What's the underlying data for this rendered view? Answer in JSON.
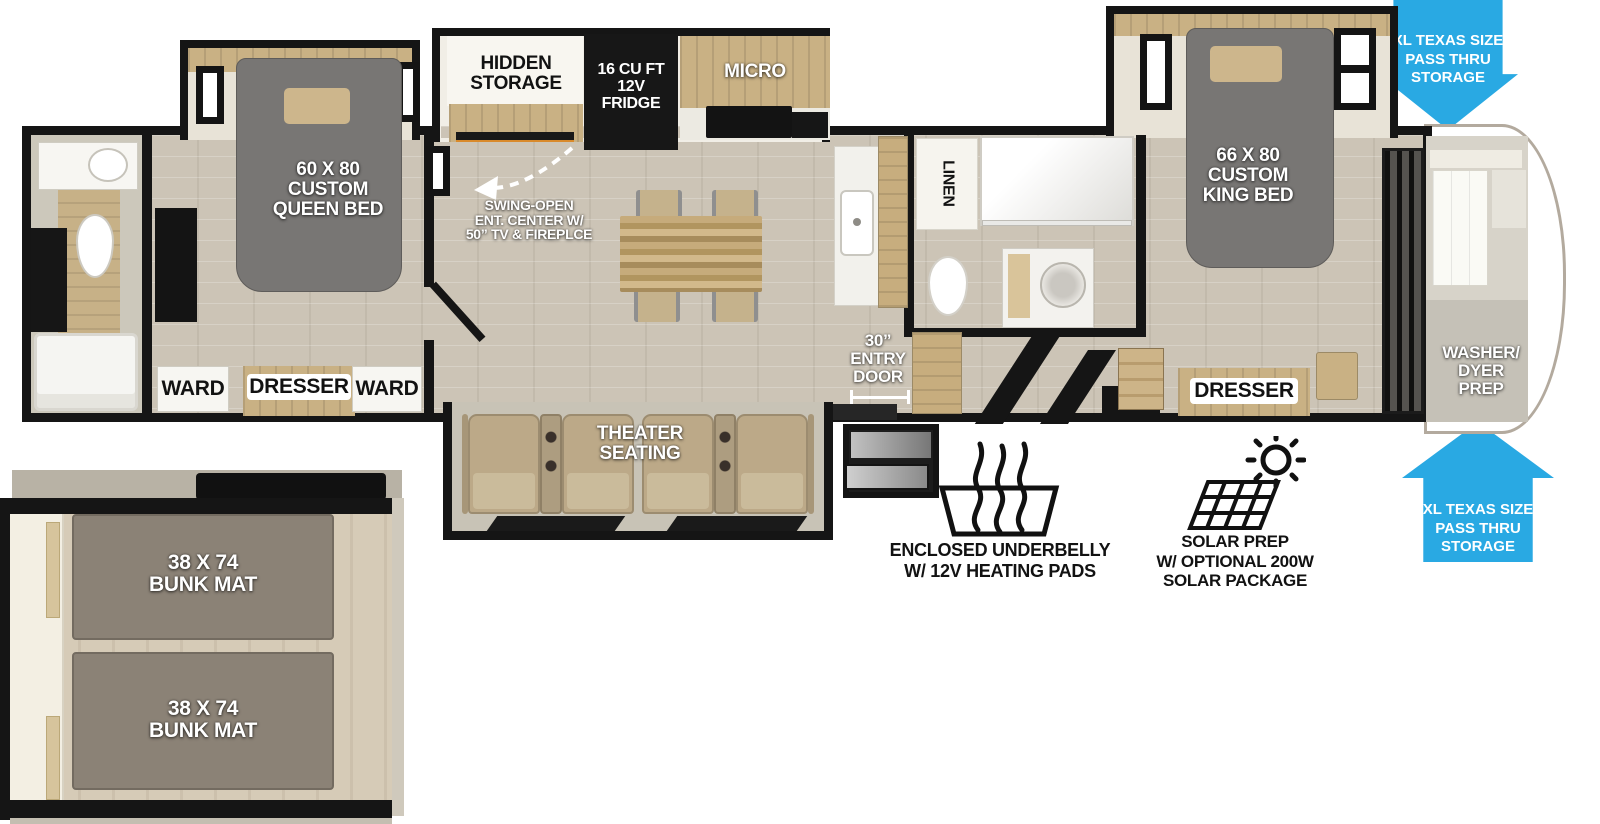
{
  "labels": {
    "hidden_storage": "HIDDEN\nSTORAGE",
    "fridge": "16 CU FT\n12V\nFRIDGE",
    "micro": "MICRO",
    "swing_open": "SWING-OPEN\nENT. CENTER W/\n50” TV & FIREPLCE",
    "queen_bed": "60 X 80\nCUSTOM\nQUEEN BED",
    "ward_left": "WARD",
    "dresser_front": "DRESSER",
    "ward_right": "WARD",
    "theater_seating": "THEATER\nSEATING",
    "linen": "LINEN",
    "entry_door": "30”\nENTRY\nDOOR",
    "king_bed": "66 X 80\nCUSTOM\nKING BED",
    "dresser_rear": "DRESSER",
    "washer_dryer": "WASHER/\nDYER\nPREP",
    "pass_thru_top": "XL TEXAS SIZE\nPASS THRU\nSTORAGE",
    "pass_thru_bottom": "XL TEXAS SIZE\nPASS THRU\nSTORAGE",
    "underbelly": "ENCLOSED UNDERBELLY\nW/ 12V HEATING PADS",
    "solar": "SOLAR PREP\nW/ OPTIONAL 200W\nSOLAR PACKAGE",
    "bunk_top": "38 X 74\nBUNK MAT",
    "bunk_bottom": "38 X 74\nBUNK MAT"
  },
  "icons": {
    "underbelly": "heat-waves-icon",
    "solar": "solar-panel-sun-icon",
    "pass_thru_top": "arrow-down",
    "pass_thru_bottom": "arrow-up",
    "swing_open": "dashed-curve-arrow"
  },
  "colors": {
    "arrow_blue": "#29a9e3",
    "wall_black": "#151515",
    "bed_gray": "#787674",
    "bunk_mat_gray": "#8b8276",
    "wood_tan": "#c9b184",
    "floor_light": "#d3ccbf",
    "seat_tan": "#bca988"
  }
}
